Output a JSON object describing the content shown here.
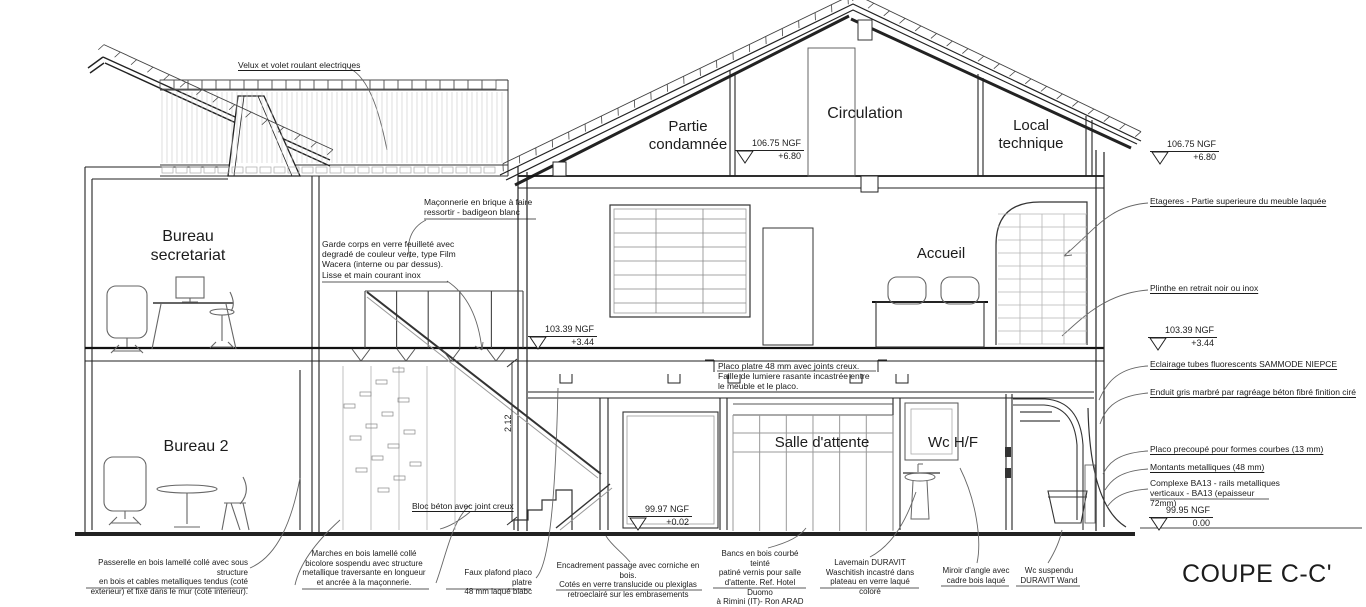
{
  "title": "COUPE C-C'",
  "rooms": [
    {
      "id": "bureau-secretariat",
      "label": "Bureau\nsecretariat"
    },
    {
      "id": "bureau-2",
      "label": "Bureau 2"
    },
    {
      "id": "partie-condamnee",
      "label": "Partie\ncondamnée"
    },
    {
      "id": "circulation",
      "label": "Circulation"
    },
    {
      "id": "local-technique",
      "label": "Local\ntechnique"
    },
    {
      "id": "accueil",
      "label": "Accueil"
    },
    {
      "id": "salle-attente",
      "label": "Salle d'attente"
    },
    {
      "id": "wc-hf",
      "label": "Wc H/F"
    }
  ],
  "levels": [
    {
      "value": "106.75 NGF",
      "offset": "+6.80"
    },
    {
      "value": "106.75 NGF",
      "offset": "+6.80"
    },
    {
      "value": "103.39 NGF",
      "offset": "+3.44"
    },
    {
      "value": "103.39 NGF",
      "offset": "+3.44"
    },
    {
      "value": "99.97 NGF",
      "offset": "+0.02"
    },
    {
      "value": "99.95 NGF",
      "offset": "0.00"
    }
  ],
  "dimension": "2.12",
  "callouts": {
    "velux": "Velux et volet roulant electriques",
    "maconnerie": "Maçonnerie en brique à faire\nressortir - badigeon blanc",
    "garde_corps": "Garde corps en verre feuilleté avec\ndegradé de couleur verte, type Film\nWacera (interne ou par dessus).\nLisse et main courant inox",
    "placo_joints": "Placo platre 48 mm avec joints creux.\nFaille de lumiere rasante incastrée entre\nle meuble et le placo.",
    "bloc_beton": "Bloc béton avec joint creux"
  },
  "right_annotations": [
    {
      "label": "Etageres - Partie superieure du meuble laquée"
    },
    {
      "label": "Plinthe en retrait noir ou inox"
    },
    {
      "label": "Eclairage tubes fluorescents SAMMODE NIEPCE"
    },
    {
      "label": "Enduit gris marbré par ragréage béton fibré finition ciré"
    },
    {
      "label": "Placo precoupé pour formes courbes (13 mm)"
    },
    {
      "label": "Montants metalliques (48 mm)"
    },
    {
      "label": "Complexe BA13 - rails metalliques\nverticaux - BA13 (epaisseur 72mm)"
    }
  ],
  "bottom_annotations": [
    {
      "label": "Passerelle en bois lamellé collé avec sous structure\nen bois et cables metalliques tendus (coté\nexterieur) et fixé dans le mur (coté interieur)."
    },
    {
      "label": "Marches en bois lamellé collé\nbicolore sospendu avec structure\nmetallique traversante en longueur\net ancrée à la maçonnerie."
    },
    {
      "label": "Faux plafond placo platre\n48 mm laqué blabc"
    },
    {
      "label": "Encadrement passage avec corniche en bois.\nCotés en verre translucide ou plexiglas\nretroeclairé sur les embrasements"
    },
    {
      "label": "Bancs en bois courbé teinté\npatiné vernis pour salle\nd'attente. Ref. Hotel Duomo\nà Rimini (IT)- Ron ARAD"
    },
    {
      "label": "Lavemain DURAVIT\nWaschitish incastré dans\nplateau en verre laqué coloré"
    },
    {
      "label": "Miroir d'angle avec\ncadre bois laqué"
    },
    {
      "label": "Wc suspendu\nDURAVIT Wand"
    }
  ],
  "colors": {
    "line": "#1c1c1c",
    "light_line": "#999999",
    "hatch": "#c9c9c9"
  }
}
